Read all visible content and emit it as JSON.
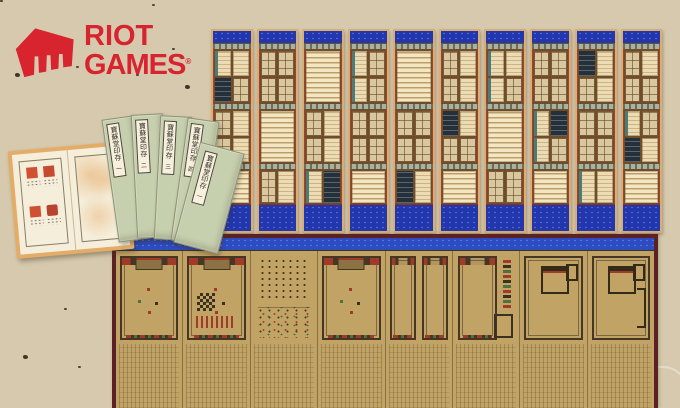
{
  "logo": {
    "word1": "RIOT",
    "word2": "GAMES",
    "registered": "®",
    "color": "#d8242f"
  },
  "scene": {
    "background_color": "#d6c9ad",
    "top_screen": {
      "kind": "chaekgeori bookshelf folding screen",
      "panel_count": 10,
      "accent_blue": "#2236ae",
      "panels": [
        {
          "sections": [
            "bbkd",
            "dbdb",
            "S"
          ]
        },
        {
          "sections": [
            "dddd",
            "S",
            "db"
          ]
        },
        {
          "sections": [
            "S",
            "dbdb",
            "bk"
          ]
        },
        {
          "sections": [
            "bdbd",
            "dddd",
            "S"
          ]
        },
        {
          "sections": [
            "S",
            "dddd",
            "kb"
          ]
        },
        {
          "sections": [
            "dbdb",
            "kbdd",
            "S"
          ]
        },
        {
          "sections": [
            "bbbd",
            "S",
            "dd"
          ]
        },
        {
          "sections": [
            "dddd",
            "bkbd",
            "S"
          ]
        },
        {
          "sections": [
            "kbdb",
            "dddd",
            "bb"
          ]
        },
        {
          "sections": [
            "dbdd",
            "bdkb",
            "S"
          ]
        }
      ]
    },
    "bottom_screen": {
      "kind": "palace ritual plan folding screen",
      "panel_count": 8,
      "band_blue": "#2c4cc2",
      "silk_tan": "#c2a366",
      "border_maroon": "#5b2125",
      "panels": [
        {
          "type": "hall"
        },
        {
          "type": "hall-checker"
        },
        {
          "type": "figures"
        },
        {
          "type": "hall"
        },
        {
          "type": "hall-pair"
        },
        {
          "type": "hall-col"
        },
        {
          "type": "court"
        },
        {
          "type": "court-r"
        }
      ]
    },
    "books": {
      "cover_green": "#c7d0ae",
      "title_slip_text": "寶蘇堂印存",
      "volume_marks": [
        "一",
        "二",
        "三",
        "四",
        "一"
      ],
      "open_book": {
        "seal_color": "#d05034",
        "seal_count": 4
      }
    }
  }
}
